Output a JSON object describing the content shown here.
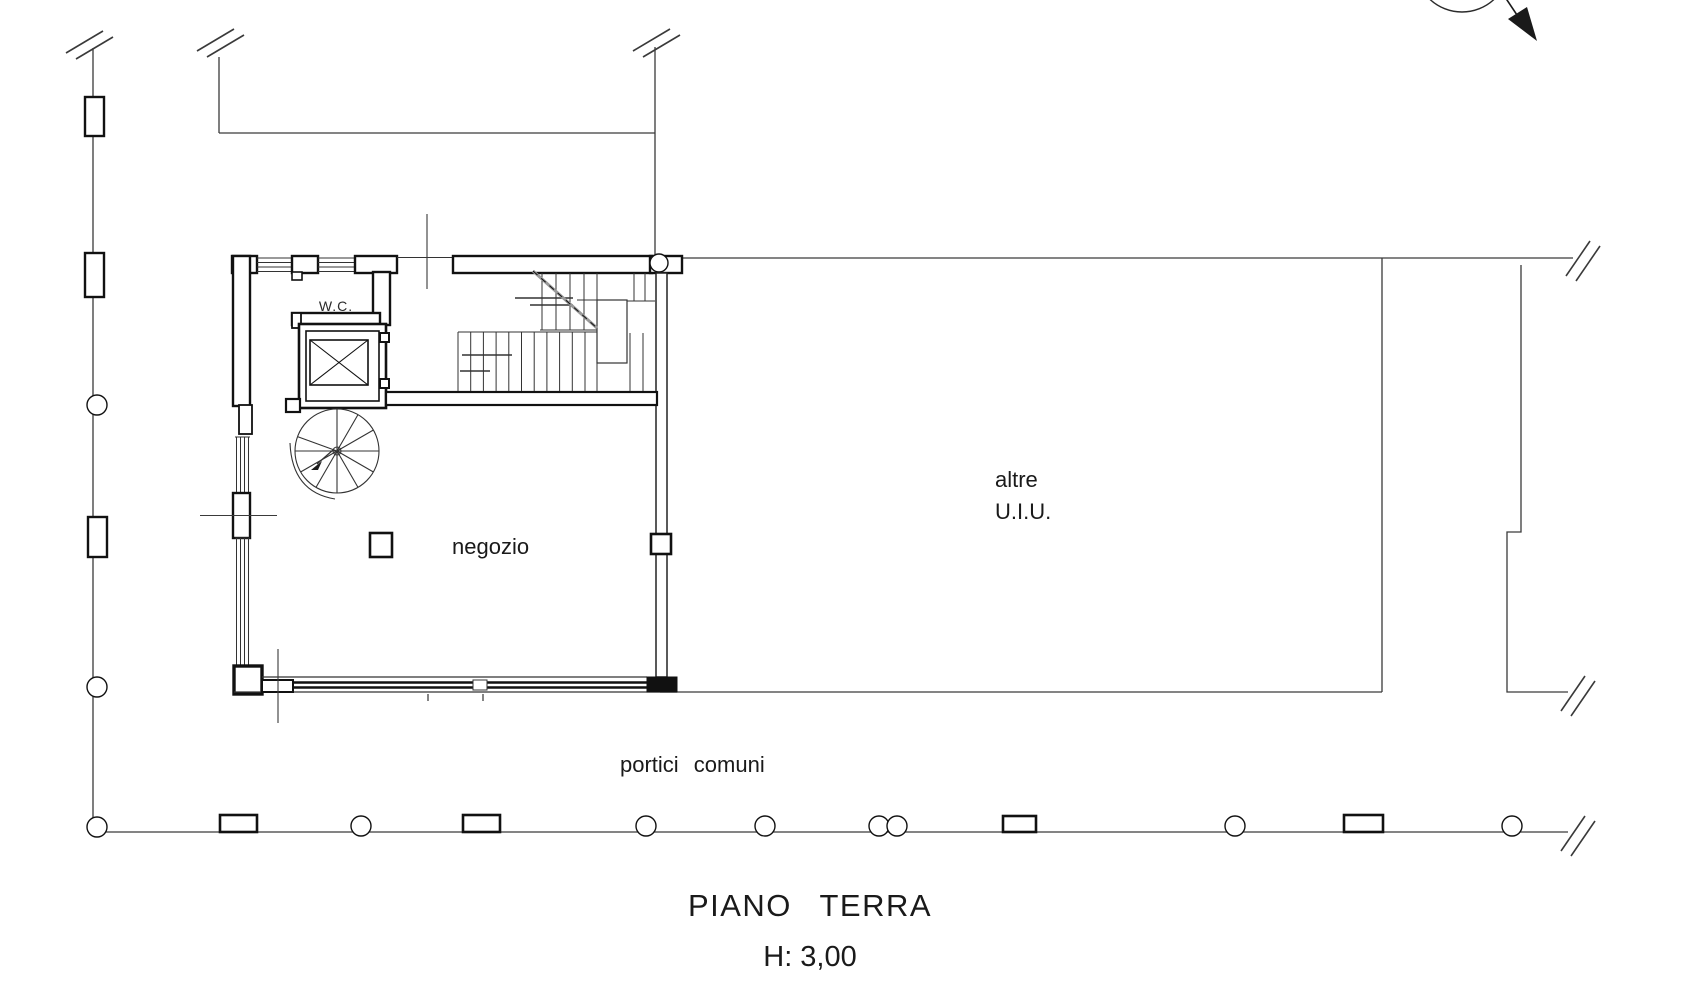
{
  "drawing": {
    "type": "architectural floor plan",
    "labels": {
      "wc": "W.C.",
      "negozio": "negozio",
      "altre_line1": "altre",
      "altre_line2": "U.I.U.",
      "portici": "portici comuni",
      "floor_title": "PIANO TERRA",
      "floor_height": "H: 3,00"
    },
    "icons": {
      "north_arrow": "north-arrow",
      "break_mark": "line-break-slashes",
      "column_round": "round-column",
      "column_square": "square-pilaster",
      "elevator": "elevator-shaft-x",
      "spiral_stair": "spiral-staircase",
      "stair": "straight-staircase"
    },
    "colors": {
      "paper": "#ffffff",
      "ink": "#1a1a1a",
      "wall": "#111111",
      "thin_line": "#3a3a3a",
      "cut_diagonal": "#999999"
    }
  }
}
